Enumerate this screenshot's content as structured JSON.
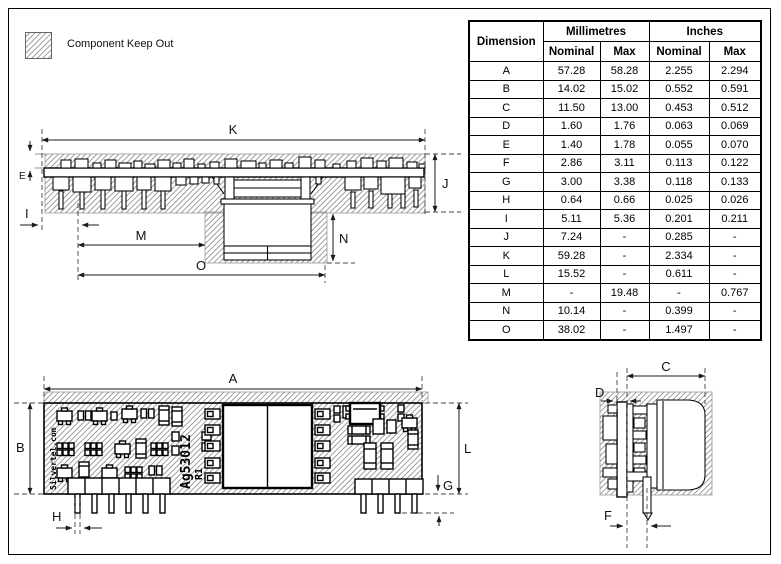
{
  "legend": {
    "label": "Component Keep Out"
  },
  "table": {
    "corner_header": "Dimension",
    "group_headers": [
      "Millimetres",
      "Inches"
    ],
    "sub_headers": [
      "Nominal",
      "Max",
      "Nominal",
      "Max"
    ],
    "rows": [
      [
        "A",
        "57.28",
        "58.28",
        "2.255",
        "2.294"
      ],
      [
        "B",
        "14.02",
        "15.02",
        "0.552",
        "0.591"
      ],
      [
        "C",
        "11.50",
        "13.00",
        "0.453",
        "0.512"
      ],
      [
        "D",
        "1.60",
        "1.76",
        "0.063",
        "0.069"
      ],
      [
        "E",
        "1.40",
        "1.78",
        "0.055",
        "0.070"
      ],
      [
        "F",
        "2.86",
        "3.11",
        "0.113",
        "0.122"
      ],
      [
        "G",
        "3.00",
        "3.38",
        "0.118",
        "0.133"
      ],
      [
        "H",
        "0.64",
        "0.66",
        "0.025",
        "0.026"
      ],
      [
        "I",
        "5.11",
        "5.36",
        "0.201",
        "0.211"
      ],
      [
        "J",
        "7.24",
        "-",
        "0.285",
        "-"
      ],
      [
        "K",
        "59.28",
        "-",
        "2.334",
        "-"
      ],
      [
        "L",
        "15.52",
        "-",
        "0.611",
        "-"
      ],
      [
        "M",
        "-",
        "19.48",
        "-",
        "0.767"
      ],
      [
        "N",
        "10.14",
        "-",
        "0.399",
        "-"
      ],
      [
        "O",
        "38.02",
        "-",
        "1.497",
        "-"
      ]
    ]
  },
  "views": {
    "side": {
      "labels": {
        "k": "K",
        "j": "J",
        "e": "E",
        "i": "I",
        "m": "M",
        "n": "N",
        "o": "O"
      }
    },
    "top": {
      "labels": {
        "a": "A",
        "b": "B",
        "l": "L",
        "g": "G",
        "h": "H"
      },
      "silkscreen": {
        "brand": "Silvertel.com",
        "part": "Ag53012",
        "rev": "R1"
      }
    },
    "end": {
      "labels": {
        "c": "C",
        "d": "D",
        "f": "F"
      }
    }
  }
}
